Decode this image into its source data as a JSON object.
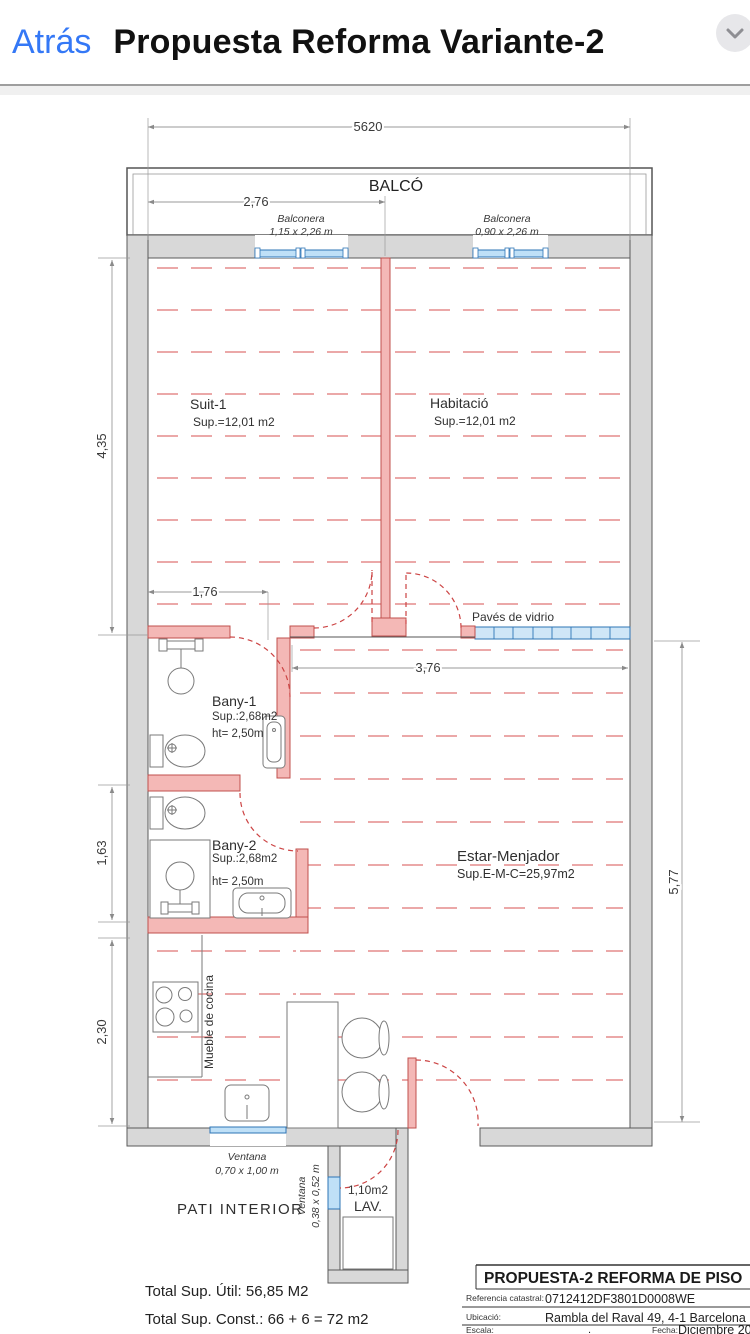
{
  "header": {
    "back_label": "Atrás",
    "title": "Propuesta Reforma Variante-2"
  },
  "plan": {
    "dims": {
      "width_total": "5620",
      "balcony_door": "2,76",
      "bedrooms_depth": "4,35",
      "hall_width": "1,76",
      "estar_width": "3,76",
      "bany2_depth": "1,63",
      "kitchen_depth": "2,30",
      "estar_depth": "5,77"
    },
    "balcony": {
      "label": "BALCÓ",
      "door_left_name": "Balconera",
      "door_left_size": "1,15 x 2,26 m",
      "door_right_name": "Balconera",
      "door_right_size": "0,90 x 2,26 m"
    },
    "rooms": {
      "suit1": {
        "name": "Suit-1",
        "area": "Sup.=12,01 m2"
      },
      "habitacio": {
        "name": "Habitació",
        "area": "Sup.=12,01 m2"
      },
      "bany1": {
        "name": "Bany-1",
        "area": "Sup.:2,68m2",
        "height": "ht= 2,50m"
      },
      "bany2": {
        "name": "Bany-2",
        "area": "Sup.:2,68m2",
        "height": "ht= 2,50m"
      },
      "estar": {
        "name": "Estar-Menjador",
        "area": "Sup.E-M-C=25,97m2"
      },
      "lav": {
        "area": "1,10m2",
        "name": "LAV."
      },
      "pati": "PATI INTERIOR"
    },
    "features": {
      "paves": "Pavés de vidrio",
      "mueble": "Mueble de cocina",
      "ventana_kitchen_name": "Ventana",
      "ventana_kitchen_size": "0,70 x 1,00 m",
      "ventana_lav_name": "Ventana",
      "ventana_lav_size": "0,38 x 0,52 m"
    },
    "totals": {
      "util": "Total Sup. Útil: 56,85 M2",
      "construida": "Total Sup. Const.: 66 + 6 = 72 m2"
    },
    "titleblock": {
      "title": "PROPUESTA-2 REFORMA DE PISO",
      "ref_label": "Referencia catastral:",
      "ref_value": "0712412DF3801D0008WE",
      "location_label": "Ubicació:",
      "location_value": "Rambla del Raval 49, 4-1 Barcelona",
      "scale_label": "Escala:",
      "scale_value": ".",
      "date_label": "Fecha:",
      "date_value": "Diciembre 2022"
    }
  },
  "colors": {
    "ios_blue": "#3478f6",
    "wall_gray": "#d8d8d8",
    "new_wall_pink": "#f4b8b6",
    "new_wall_red": "#c0504d",
    "window_blue": "#2e75b6",
    "glass_fill": "#cfe6f7",
    "floor_dash_pink": "#eba8a8"
  }
}
